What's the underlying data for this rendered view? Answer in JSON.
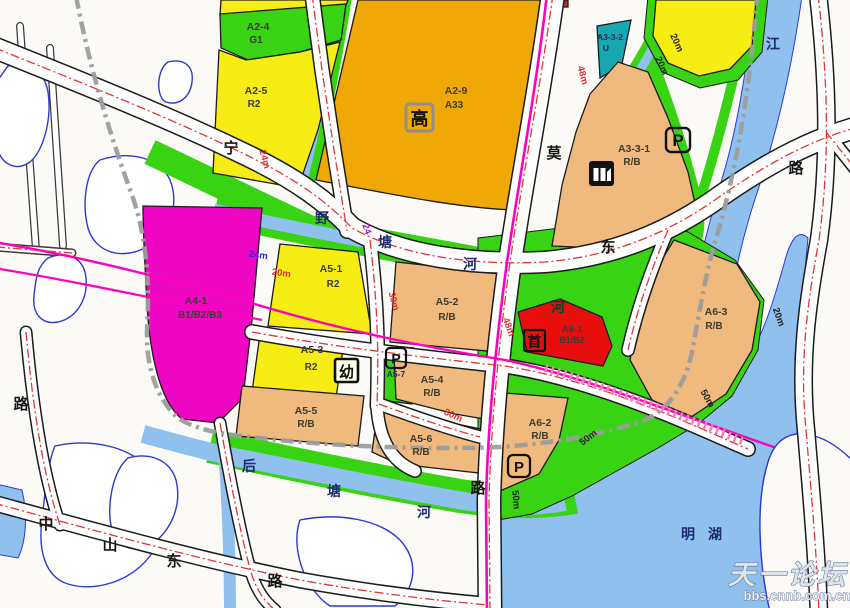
{
  "map": {
    "colors": {
      "yellow": "#f7ec13",
      "amber": "#f0a805",
      "tan": "#f0b97d",
      "green": "#38d414",
      "teal": "#17a8b2",
      "magenta": "#ee06c3",
      "red": "#e90e0e",
      "water": "#8fc0ee",
      "road_centerline": "#e23434",
      "metro": "#ff00bb",
      "boundary": "#9b9b9b"
    },
    "parcels": [
      {
        "code": "A2-4",
        "use": "G1"
      },
      {
        "code": "A2-5",
        "use": "R2"
      },
      {
        "code": "A2-9",
        "use": "A33"
      },
      {
        "code": "A3-3-2",
        "use": "U"
      },
      {
        "code": "A3-3-1",
        "use": "R/B"
      },
      {
        "code": "A4-1",
        "use": "B1/B2/B3"
      },
      {
        "code": "A5-1",
        "use": "R2"
      },
      {
        "code": "A5-2",
        "use": "R/B"
      },
      {
        "code": "A5-3",
        "use": "R2"
      },
      {
        "code": "A5-7",
        "use": ""
      },
      {
        "code": "A5-4",
        "use": "R/B"
      },
      {
        "code": "A5-5",
        "use": "R/B"
      },
      {
        "code": "A5-6",
        "use": "R/B"
      },
      {
        "code": "A6-1",
        "use": "B1/B2"
      },
      {
        "code": "A6-2",
        "use": "R/B"
      },
      {
        "code": "A6-3",
        "use": "R/B"
      }
    ],
    "road_labels": [
      {
        "text": "宁"
      },
      {
        "text": "莫"
      },
      {
        "text": "东"
      },
      {
        "text": "路"
      },
      {
        "text": "路"
      },
      {
        "text": "中"
      },
      {
        "text": "山"
      },
      {
        "text": "东"
      },
      {
        "text": "路"
      },
      {
        "text": "路"
      }
    ],
    "water_labels": [
      {
        "text": "野"
      },
      {
        "text": "塘"
      },
      {
        "text": "河"
      },
      {
        "text": "河"
      },
      {
        "text": "后"
      },
      {
        "text": "塘"
      },
      {
        "text": "河"
      },
      {
        "text": "江"
      },
      {
        "text": "明"
      },
      {
        "text": "湖"
      }
    ],
    "width_markers": [
      {
        "text": "24m",
        "color": "#e03030"
      },
      {
        "text": "24m",
        "color": "#2525d8"
      },
      {
        "text": "20m",
        "color": "#e03030"
      },
      {
        "text": "24",
        "color": "#8822cc"
      },
      {
        "text": "30m",
        "color": "#e03030"
      },
      {
        "text": "48m",
        "color": "#e03030"
      },
      {
        "text": "48m",
        "color": "#e03030"
      },
      {
        "text": "30m",
        "color": "#e03030"
      },
      {
        "text": "50m",
        "color": "#222222"
      },
      {
        "text": "50m",
        "color": "#222222"
      },
      {
        "text": "50m",
        "color": "#222222"
      },
      {
        "text": "20m",
        "color": "#222222"
      },
      {
        "text": "20m",
        "color": "#222222"
      },
      {
        "text": "20m",
        "color": "#222222"
      }
    ],
    "icons": {
      "parking": "P",
      "kindergarten": "幼",
      "headquarters": "首",
      "highschool": "高"
    },
    "watermark": {
      "site_name": "天一论坛",
      "site_url": "bbs.cnnb.com.cn"
    }
  }
}
